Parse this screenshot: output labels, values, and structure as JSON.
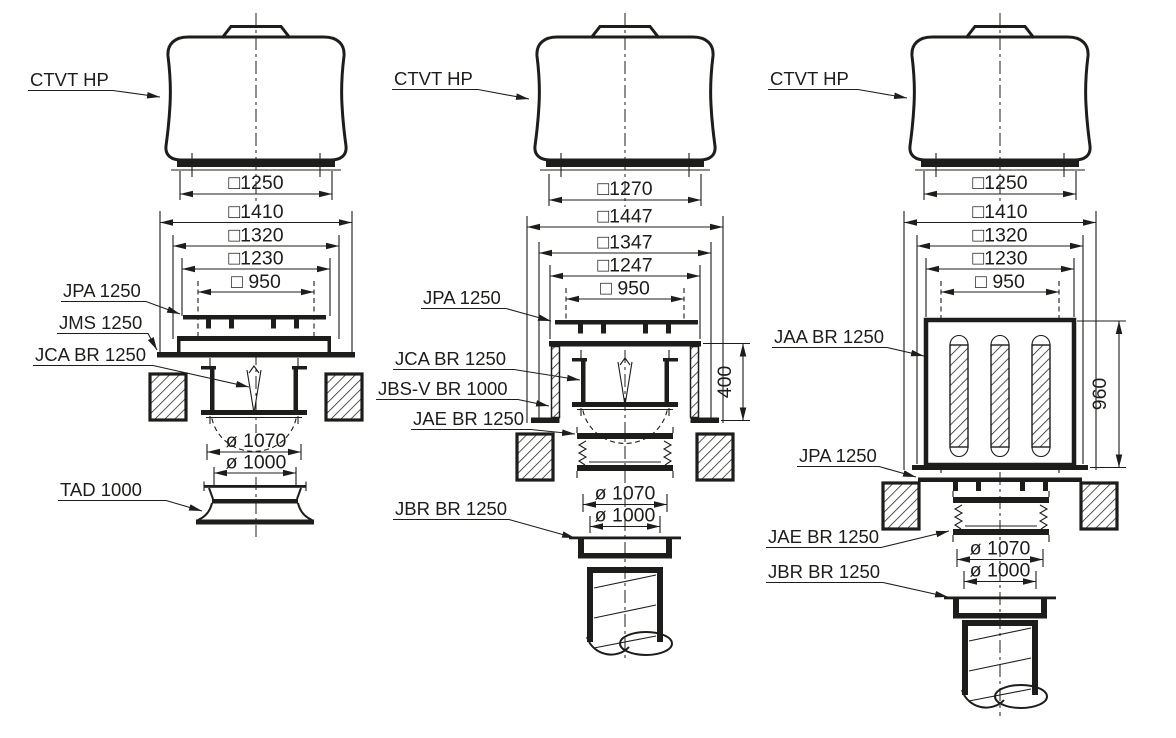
{
  "colors": {
    "ink": "#1d1d1b",
    "background": "#ffffff"
  },
  "diagrams": [
    {
      "fan_label": "CTVT HP",
      "square_dims": [
        "□1250",
        "□1410",
        "□1320",
        "□1230",
        "□ 950"
      ],
      "dia_dims": [
        "ø 1070",
        "ø 1000"
      ],
      "part_labels": [
        "JPA 1250",
        "JMS 1250",
        "JCA BR 1250",
        "TAD 1000"
      ]
    },
    {
      "fan_label": "CTVT HP",
      "square_dims": [
        "□1270",
        "□1447",
        "□1347",
        "□1247",
        "□ 950"
      ],
      "dia_dims": [
        "ø 1070",
        "ø 1000"
      ],
      "height_dim": "400",
      "part_labels": [
        "JPA 1250",
        "JCA BR 1250",
        "JBS-V BR 1000",
        "JAE BR 1250",
        "JBR BR 1250"
      ]
    },
    {
      "fan_label": "CTVT HP",
      "square_dims": [
        "□1250",
        "□1410",
        "□1320",
        "□1230",
        "□ 950"
      ],
      "dia_dims": [
        "ø 1070",
        "ø 1000"
      ],
      "height_dim": "960",
      "part_labels": [
        "JAA BR 1250",
        "JPA 1250",
        "JAE BR 1250",
        "JBR BR 1250"
      ]
    }
  ]
}
